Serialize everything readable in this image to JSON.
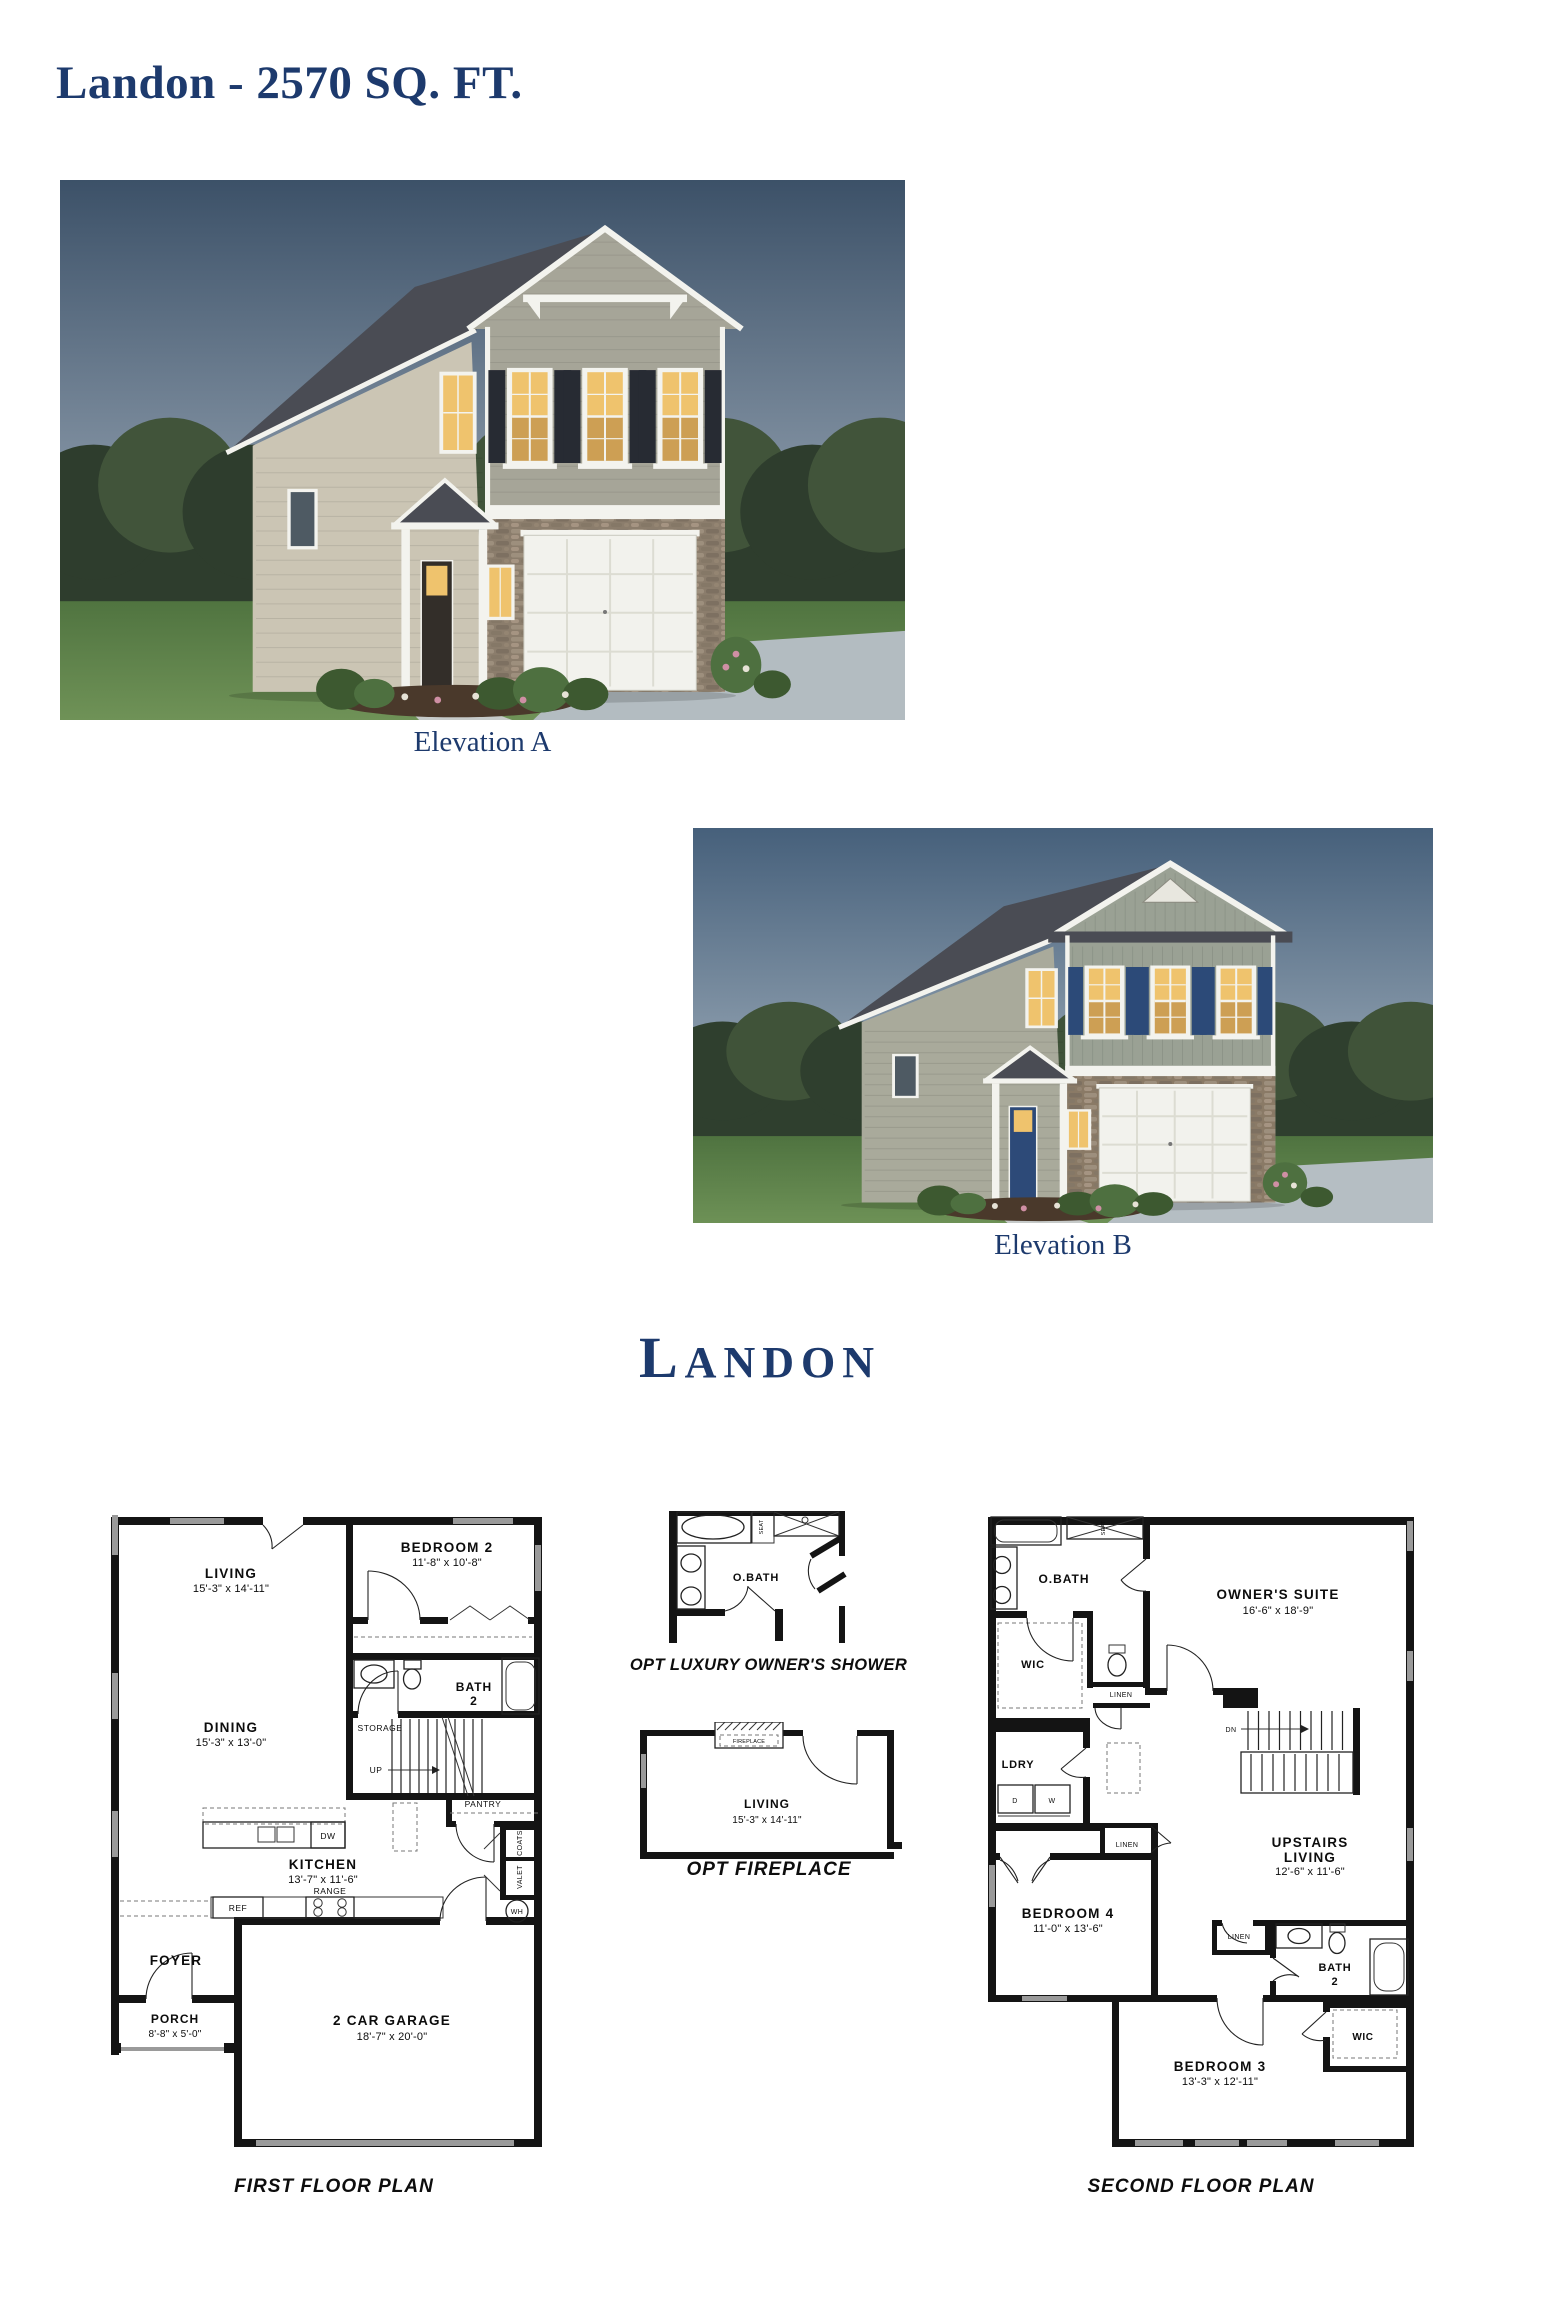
{
  "page": {
    "title": "Landon - 2570 SQ. FT.",
    "plan_name": "Landon"
  },
  "colors": {
    "heading_navy": "#1d3a6d",
    "plan_ink": "#141414",
    "window_gray": "#9a9a9a"
  },
  "elevations": [
    {
      "label": "Elevation A",
      "style": "craftsman-brackets",
      "palette": {
        "sky_top": "#3c5168",
        "sky_bottom": "#a6b3c0",
        "tree_dark": "#2e3d2d",
        "tree_mid": "#41543a",
        "grass_top": "#507440",
        "grass_bottom": "#6f9257",
        "siding": "#cbc5b4",
        "gable_siding": "#a6a598",
        "trim": "#f3f3ee",
        "roof": "#4a4c54",
        "stone": "#8b7d6c",
        "shutter": "#272b33",
        "door": "#332e29",
        "window_glow": "#efc36d",
        "driveway": "#b3bcc1"
      }
    },
    {
      "label": "Elevation B",
      "style": "board-batten-vent",
      "palette": {
        "sky_top": "#46607b",
        "sky_bottom": "#aab7c2",
        "tree_dark": "#2f3f2e",
        "tree_mid": "#405339",
        "grass_top": "#4f7340",
        "grass_bottom": "#6d9156",
        "siding": "#a9aa9b",
        "gable_siding": "#9aa194",
        "trim": "#f3f3ee",
        "roof": "#4a4c54",
        "stone": "#8a7a66",
        "shutter": "#2c4a78",
        "door": "#2d4a78",
        "window_glow": "#efc36d",
        "driveway": "#b5bec3"
      }
    }
  ],
  "plans": {
    "first_floor": {
      "caption": "FIRST FLOOR PLAN",
      "rooms": {
        "living": {
          "name": "LIVING",
          "dims": "15'-3\" x 14'-11\""
        },
        "bedroom2": {
          "name": "BEDROOM 2",
          "dims": "11'-8\" x 10'-8\""
        },
        "bath2": {
          "line1": "BATH",
          "line2": "2"
        },
        "dining": {
          "name": "DINING",
          "dims": "15'-3\" x 13'-0\""
        },
        "kitchen": {
          "name": "KITCHEN",
          "dims": "13'-7\" x 11'-6\""
        },
        "foyer": {
          "name": "FOYER"
        },
        "porch": {
          "name": "PORCH",
          "dims": "8'-8\" x 5'-0\""
        },
        "garage": {
          "name": "2 CAR GARAGE",
          "dims": "18'-7\" x 20'-0\""
        }
      },
      "labels": {
        "storage": "STORAGE",
        "up": "UP",
        "pantry": "PANTRY",
        "coats": "COATS",
        "valet": "VALET",
        "wh": "WH",
        "ref": "REF",
        "range": "RANGE",
        "dw": "DW"
      }
    },
    "options": {
      "owners_shower": {
        "caption": "OPT LUXURY OWNER'S SHOWER",
        "room": "O.BATH",
        "seat": "SEAT"
      },
      "fireplace": {
        "caption": "OPT FIREPLACE",
        "fireplace_label": "FIREPLACE",
        "room": {
          "name": "LIVING",
          "dims": "15'-3\" x 14'-11\""
        }
      }
    },
    "second_floor": {
      "caption": "SECOND FLOOR PLAN",
      "rooms": {
        "obath": {
          "name": "O.BATH"
        },
        "owners_suite": {
          "name": "OWNER'S SUITE",
          "dims": "16'-6\" x 18'-9\""
        },
        "wic1": {
          "name": "WIC"
        },
        "ldry": {
          "name": "LDRY"
        },
        "bedroom4": {
          "name": "BEDROOM 4",
          "dims": "11'-0\" x 13'-6\""
        },
        "upstairs_living": {
          "line1": "UPSTAIRS",
          "line2": "LIVING",
          "dims": "12'-6\" x 11'-6\""
        },
        "bath2": {
          "line1": "BATH",
          "line2": "2"
        },
        "wic2": {
          "name": "WIC"
        },
        "bedroom3": {
          "name": "BEDROOM 3",
          "dims": "13'-3\" x 12'-11\""
        }
      },
      "labels": {
        "linen1": "LINEN",
        "linen2": "LINEN",
        "linen3": "LINEN",
        "dn": "DN",
        "d": "D",
        "w": "W",
        "seat": "SEAT"
      }
    }
  }
}
